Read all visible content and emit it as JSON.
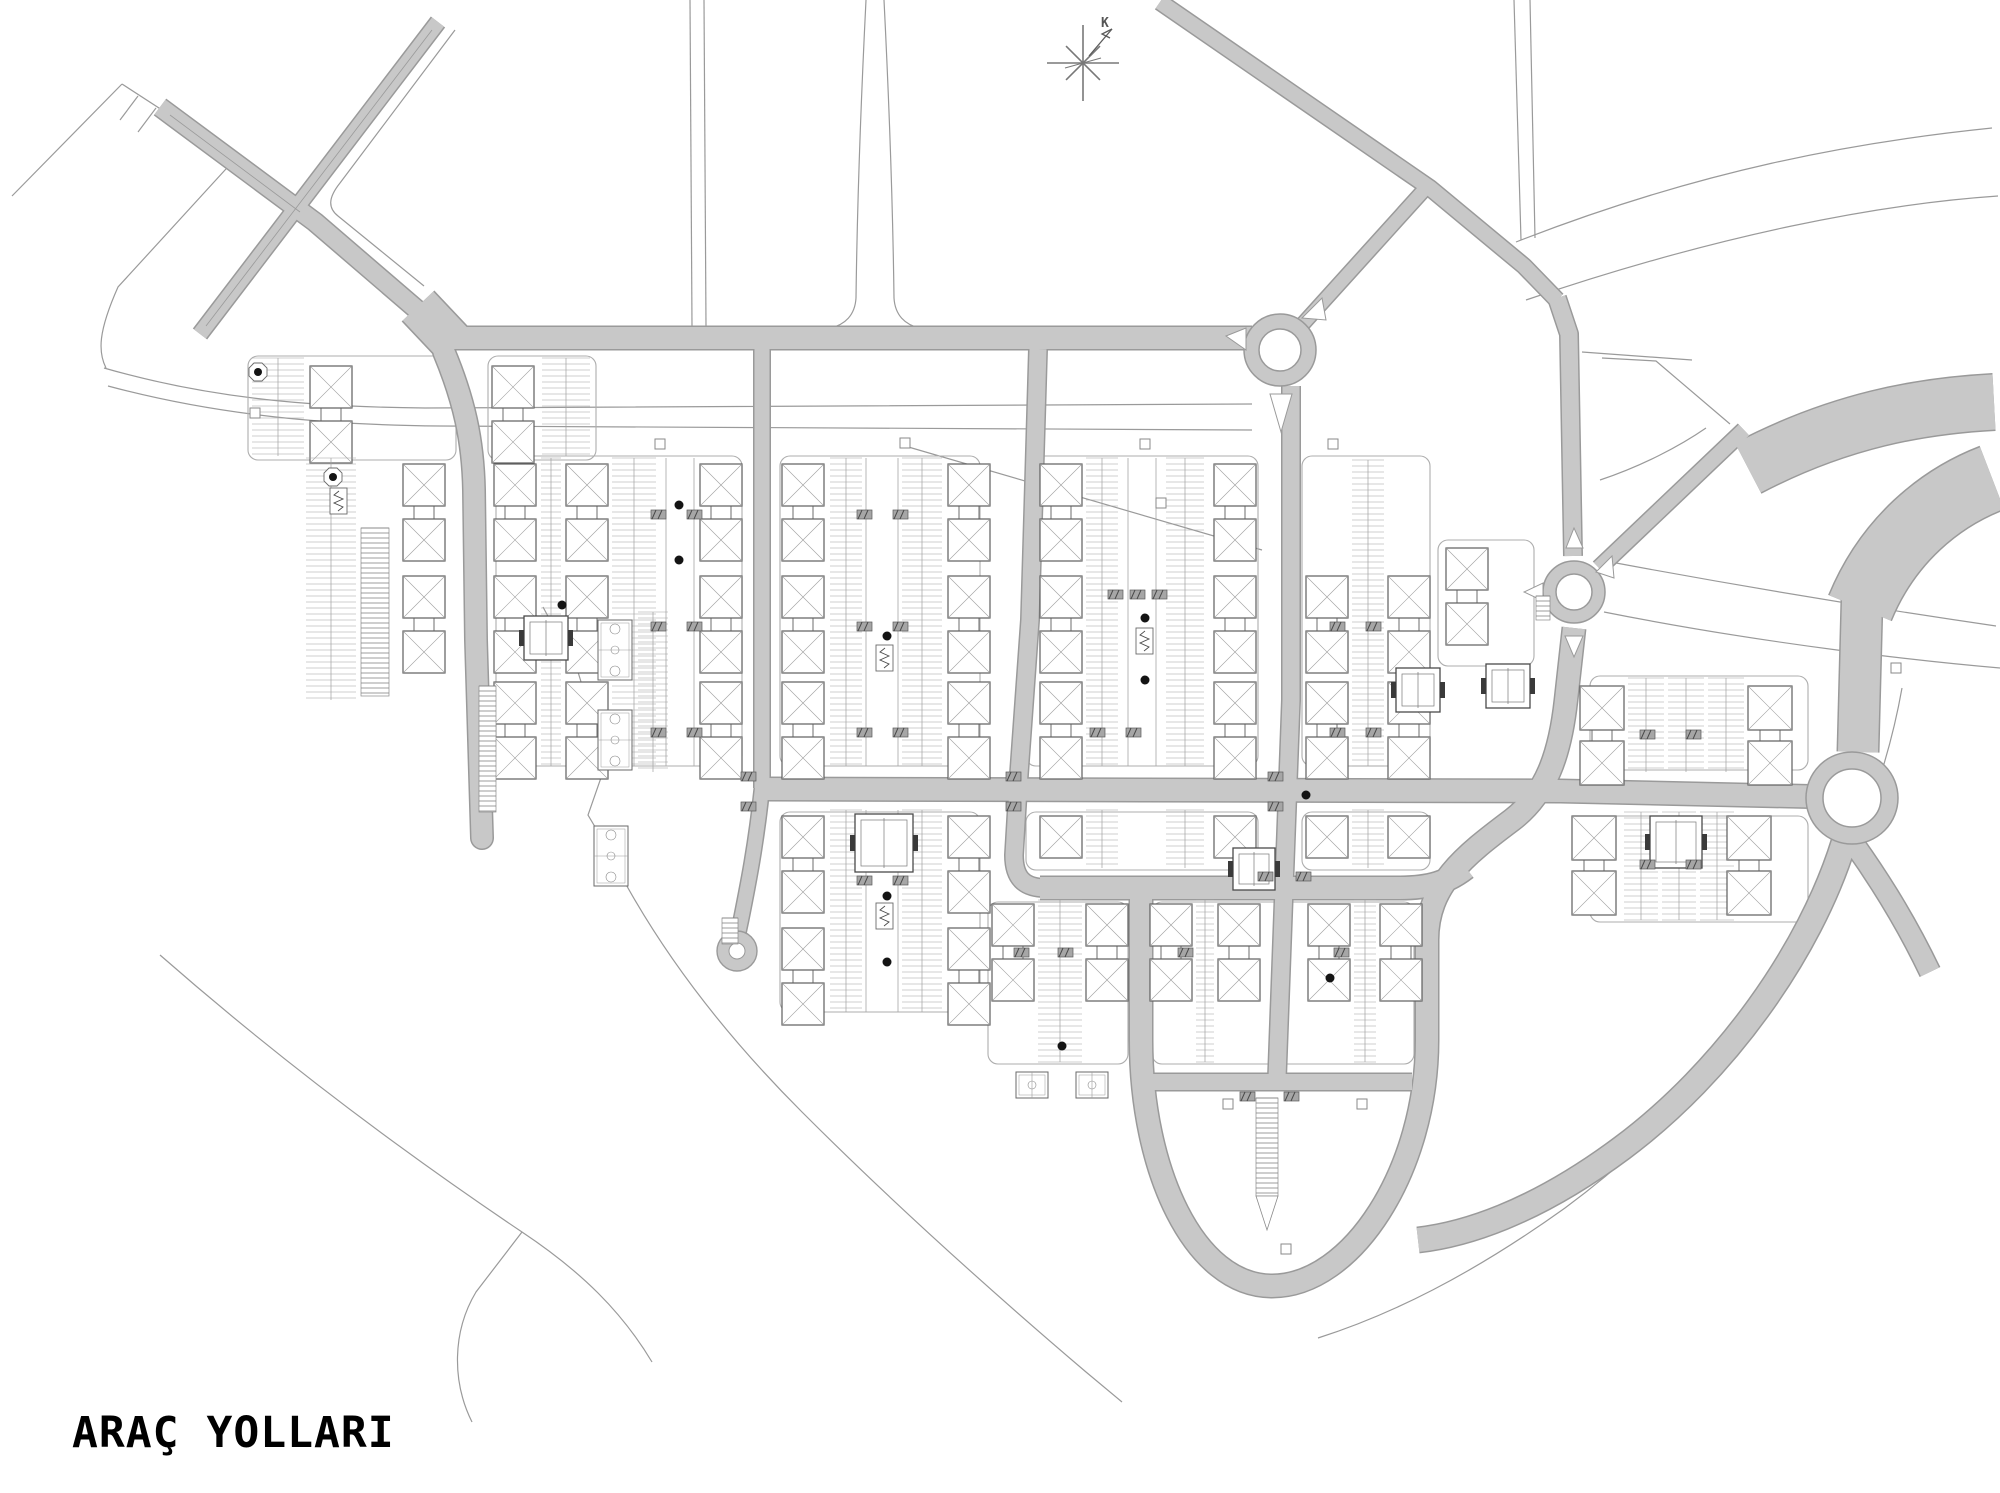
{
  "canvas": {
    "w": 2000,
    "h": 1493
  },
  "title": {
    "text": "ARAÇ YOLLARI"
  },
  "compass": {
    "cx": 1083,
    "cy": 63,
    "label": "K"
  },
  "colors": {
    "bg": "#ffffff",
    "road_fill": "#c8c8c8",
    "road_edge": "#9a9a9a",
    "thin": "#9a9a9a",
    "boundary": "#8d8d8d",
    "plot": "#aeaeae",
    "building": "#5e5e5e",
    "roof": "#a0a0a0",
    "comb": "#9f9f9f",
    "spine": "#a5a5a5",
    "tick_fill": "#a6a6a6",
    "tick_dark": "#4a4a4a",
    "special": "#4a4a4a",
    "tree": "#141414",
    "text": "#000000"
  },
  "roads": [
    {
      "id": "diagonal-sw",
      "d": "M 438,22 L 200,334",
      "w": 15
    },
    {
      "id": "diagonal-nwse",
      "d": "M 160,107 L 315,222 L 443,332",
      "w": 18
    },
    {
      "id": "funnel",
      "d": "M 418,306 L 452,342",
      "w": 42
    },
    {
      "id": "main-horizontal",
      "d": "M 448,338 L 1252,338",
      "w": 22
    },
    {
      "id": "rnd1-ne-link",
      "d": "M 1292,336 L 1424,190",
      "w": 13
    },
    {
      "id": "north-diagonal",
      "d": "M 1160,2 L 1430,188 L 1524,266 L 1557,300",
      "w": 15
    },
    {
      "id": "v5-north-of-rnd2",
      "d": "M 1557,298 L 1569,334 L 1573,556",
      "w": 17
    },
    {
      "id": "ne-approach",
      "d": "M 1744,430 L 1599,568",
      "w": 15
    },
    {
      "id": "v6-and-loop",
      "d": "M 1574,628 L 1566,700 C 1560,755 1546,794 1512,820 C 1464,856 1427,885 1427,940 L 1427,1040 C 1427,1170 1352,1286 1272,1286 C 1194,1286 1141,1170 1141,1040 L 1141,893",
      "w": 22
    },
    {
      "id": "h3-boulevard",
      "d": "M 1040,888 L 1400,888 C 1430,888 1448,882 1466,868",
      "w": 22
    },
    {
      "id": "h4-chord",
      "d": "M 1133,1082 L 1412,1082",
      "w": 16
    },
    {
      "id": "v1",
      "d": "M 444,352 C 464,400 473,440 474,490 L 476,640 L 482,838",
      "w": 21,
      "cap": "round"
    },
    {
      "id": "v2",
      "d": "M 762,349 L 762,788",
      "w": 15
    },
    {
      "id": "v2-south",
      "d": "M 762,788 C 756,845 748,885 741,920 C 738,934 736,942 737,949",
      "w": 14
    },
    {
      "id": "v3",
      "d": "M 1038,349 L 1030,620 L 1018,788 L 1014,855 C 1014,878 1024,888 1046,888",
      "w": 17
    },
    {
      "id": "v4",
      "d": "M 1291,386 L 1291,700 L 1284,888 L 1277,1078",
      "w": 17
    },
    {
      "id": "h2-middle",
      "d": "M 757,789 L 1560,791 L 1832,797",
      "w": 22
    },
    {
      "id": "interchange-a",
      "d": "M 1748,468 C 1840,420 1920,406 1994,402",
      "w": 55
    },
    {
      "id": "interchange-b",
      "d": "M 1992,478 C 1940,498 1888,540 1860,608",
      "w": 66
    },
    {
      "id": "interchange-c",
      "d": "M 1862,600 L 1858,752",
      "w": 40
    },
    {
      "id": "arc-south",
      "d": "M 1844,842 C 1810,952 1724,1072 1622,1148 C 1532,1215 1462,1235 1418,1240",
      "w": 24
    },
    {
      "id": "arc-se-stub",
      "d": "M 1854,844 C 1884,886 1908,926 1930,972",
      "w": 20
    }
  ],
  "overlines": [
    {
      "d": "M 432,30 L 206,326"
    },
    {
      "d": "M 170,115 L 300,212"
    }
  ],
  "roundabouts": [
    {
      "cx": 1280,
      "cy": 350,
      "ro": 36,
      "ri": 21
    },
    {
      "cx": 1574,
      "cy": 592,
      "ro": 31,
      "ri": 18
    },
    {
      "cx": 1852,
      "cy": 798,
      "ro": 46,
      "ri": 29
    }
  ],
  "cul_de_sacs": [
    {
      "cx": 737,
      "cy": 951,
      "ro": 20,
      "ri": 8
    }
  ],
  "islands": [
    "M 1226,336 L 1246,328 L 1246,350 Z",
    "M 1270,394 L 1292,394 L 1281,432 Z",
    "M 1302,318 L 1322,298 L 1326,320 Z",
    "M 1566,548 L 1583,548 L 1574,528 Z",
    "M 1565,636 L 1583,636 L 1574,657 Z",
    "M 1596,572 L 1612,556 L 1614,578 Z",
    "M 1543,583 L 1543,601 L 1524,592 Z"
  ],
  "thin_lines": [
    {
      "d": "M 455,30 L 340,183 C 328,198 328,208 338,216 L 424,286"
    },
    {
      "d": "M 122,84 L 236,158"
    },
    {
      "d": "M 122,84 L 12,196"
    },
    {
      "d": "M 236,158 L 118,287 C 98,332 98,352 106,368"
    },
    {
      "d": "M 138,96 L 120,120"
    },
    {
      "d": "M 156,108 L 138,132"
    },
    {
      "d": "M 104,368 C 215,400 320,407 425,408 L 1252,404"
    },
    {
      "d": "M 108,386 C 220,416 330,425 440,426 L 1252,430"
    },
    {
      "d": "M 690,0 L 692,326"
    },
    {
      "d": "M 704,0 L 706,326"
    },
    {
      "d": "M 866,0 C 860,120 857,220 856,298 C 855,315 845,325 830,328"
    },
    {
      "d": "M 884,0 C 890,120 893,220 894,298 C 895,315 905,325 920,328"
    },
    {
      "d": "M 1514,0 L 1521,240"
    },
    {
      "d": "M 1530,0 L 1535,238"
    },
    {
      "d": "M 1516,242 C 1700,170 1855,142 1992,128"
    },
    {
      "d": "M 1526,300 C 1720,234 1880,204 1998,196"
    },
    {
      "d": "M 1602,358 L 1656,361 L 1730,424"
    },
    {
      "d": "M 1600,480 C 1642,466 1680,446 1706,428"
    },
    {
      "d": "M 1600,560 C 1760,590 1900,612 1996,626"
    },
    {
      "d": "M 1604,612 C 1770,645 1930,662 2000,668"
    },
    {
      "d": "M 1902,688 C 1868,880 1745,1075 1565,1208 C 1470,1276 1390,1315 1318,1338"
    },
    {
      "d": "M 543,607 L 578,672 L 592,718 L 603,772 L 588,815 L 604,842 C 652,942 722,1032 802,1112 C 892,1202 992,1292 1086,1372 L 1122,1402"
    },
    {
      "d": "M 160,955 C 280,1060 400,1150 522,1232 C 582,1272 622,1312 652,1362"
    },
    {
      "d": "M 522,1232 L 476,1292 C 452,1332 452,1382 472,1422"
    },
    {
      "d": "M 1582,352 L 1692,360"
    },
    {
      "d": "M 905,446 L 1262,550"
    }
  ],
  "plots": [
    {
      "x": 496,
      "y": 456,
      "w": 246,
      "h": 310
    },
    {
      "x": 780,
      "y": 456,
      "w": 200,
      "h": 310
    },
    {
      "x": 1026,
      "y": 456,
      "w": 232,
      "h": 310
    },
    {
      "x": 1302,
      "y": 456,
      "w": 128,
      "h": 310
    },
    {
      "x": 780,
      "y": 812,
      "w": 200,
      "h": 200
    },
    {
      "x": 1026,
      "y": 812,
      "w": 232,
      "h": 58
    },
    {
      "x": 1302,
      "y": 812,
      "w": 128,
      "h": 58
    },
    {
      "x": 1152,
      "y": 902,
      "w": 262,
      "h": 162
    },
    {
      "x": 988,
      "y": 902,
      "w": 140,
      "h": 162
    },
    {
      "x": 1590,
      "y": 676,
      "w": 218,
      "h": 94
    },
    {
      "x": 1590,
      "y": 816,
      "w": 218,
      "h": 106
    },
    {
      "x": 1438,
      "y": 540,
      "w": 96,
      "h": 126
    },
    {
      "x": 248,
      "y": 356,
      "w": 208,
      "h": 104
    },
    {
      "x": 488,
      "y": 356,
      "w": 108,
      "h": 104
    }
  ],
  "clusters": [
    {
      "cols": [
        494,
        566,
        700
      ],
      "modules": [
        464,
        576,
        682
      ],
      "singles": [],
      "combs": [
        {
          "x": 541,
          "w": 20
        },
        {
          "x": 612,
          "w": 44
        }
      ],
      "spine": [
        666,
        694
      ],
      "y0": 458,
      "y1": 766
    },
    {
      "cols": [
        782,
        948
      ],
      "modules": [
        464,
        576,
        682
      ],
      "singles": [],
      "combs": [
        {
          "x": 830,
          "w": 32
        },
        {
          "x": 902,
          "w": 40
        }
      ],
      "spine": [
        866,
        898
      ],
      "y0": 458,
      "y1": 766
    },
    {
      "cols": [
        1040,
        1214
      ],
      "modules": [
        464,
        576,
        682
      ],
      "singles": [],
      "combs": [
        {
          "x": 1086,
          "w": 32
        },
        {
          "x": 1166,
          "w": 38
        }
      ],
      "spine": [
        1128,
        1156
      ],
      "y0": 458,
      "y1": 766
    },
    {
      "cols": [
        1306,
        1388
      ],
      "modules": [
        576,
        682
      ],
      "singles": [],
      "combs": [
        {
          "x": 1352,
          "w": 32
        }
      ],
      "spine": null,
      "y0": 460,
      "y1": 766
    },
    {
      "cols": [
        1446
      ],
      "modules": [
        548
      ],
      "singles": [],
      "combs": [],
      "spine": null,
      "y0": 542,
      "y1": 664
    },
    {
      "cols": [
        310
      ],
      "modules": [
        366
      ],
      "singles": [],
      "combs": [
        {
          "x": 252,
          "w": 52
        }
      ],
      "spine": null,
      "y0": 358,
      "y1": 456
    },
    {
      "cols": [
        492
      ],
      "modules": [
        366
      ],
      "singles": [],
      "combs": [
        {
          "x": 542,
          "w": 48
        }
      ],
      "spine": null,
      "y0": 358,
      "y1": 456
    },
    {
      "cols": [
        403
      ],
      "modules": [
        464,
        576
      ],
      "singles": [],
      "combs": [
        {
          "x": 306,
          "w": 50
        }
      ],
      "spine": null,
      "y0": 458,
      "y1": 700
    },
    {
      "cols": [],
      "modules": [],
      "singles": [],
      "combs": [
        {
          "x": 638,
          "w": 30
        }
      ],
      "spine": null,
      "y0": 612,
      "y1": 772
    },
    {
      "cols": [
        782,
        948
      ],
      "modules": [
        816,
        928
      ],
      "singles": [],
      "combs": [
        {
          "x": 830,
          "w": 32
        },
        {
          "x": 902,
          "w": 40
        }
      ],
      "spine": [
        866,
        898
      ],
      "y0": 810,
      "y1": 1012
    },
    {
      "cols": [
        1040,
        1214
      ],
      "modules": [],
      "singles": [
        816
      ],
      "combs": [
        {
          "x": 1086,
          "w": 32
        },
        {
          "x": 1166,
          "w": 38
        }
      ],
      "spine": null,
      "y0": 810,
      "y1": 868
    },
    {
      "cols": [
        1306,
        1388
      ],
      "modules": [],
      "singles": [
        816
      ],
      "combs": [
        {
          "x": 1352,
          "w": 32
        }
      ],
      "spine": null,
      "y0": 810,
      "y1": 868
    },
    {
      "cols": [
        1150,
        1218
      ],
      "modules": [
        904
      ],
      "singles": [],
      "combs": [
        {
          "x": 1196,
          "w": 18
        }
      ],
      "spine": null,
      "y0": 900,
      "y1": 1062
    },
    {
      "cols": [
        1308,
        1380
      ],
      "modules": [
        904
      ],
      "singles": [],
      "combs": [
        {
          "x": 1354,
          "w": 22
        }
      ],
      "spine": null,
      "y0": 900,
      "y1": 1062
    },
    {
      "cols": [
        992,
        1086
      ],
      "modules": [
        904
      ],
      "singles": [],
      "combs": [
        {
          "x": 1038,
          "w": 44
        }
      ],
      "spine": null,
      "y0": 900,
      "y1": 1062
    },
    {
      "cols": [
        1580,
        1748
      ],
      "modules": [
        686
      ],
      "singles": [],
      "combs": [
        {
          "x": 1628,
          "w": 36
        },
        {
          "x": 1668,
          "w": 36
        },
        {
          "x": 1708,
          "w": 36
        }
      ],
      "spine": null,
      "y0": 678,
      "y1": 772,
      "sq": 44
    },
    {
      "cols": [
        1572,
        1727
      ],
      "modules": [
        816
      ],
      "singles": [],
      "combs": [
        {
          "x": 1624,
          "w": 34
        },
        {
          "x": 1662,
          "w": 34
        },
        {
          "x": 1700,
          "w": 34
        }
      ],
      "spine": null,
      "y0": 812,
      "y1": 920,
      "sq": 44
    }
  ],
  "specials": [
    {
      "x": 524,
      "y": 616,
      "s": 44
    },
    {
      "x": 855,
      "y": 814,
      "s": 58
    },
    {
      "x": 1233,
      "y": 848,
      "s": 42
    },
    {
      "x": 1650,
      "y": 816,
      "s": 52
    },
    {
      "x": 1396,
      "y": 668,
      "s": 44
    },
    {
      "x": 1486,
      "y": 664,
      "s": 44
    }
  ],
  "courts": [
    {
      "x": 598,
      "y": 620,
      "w": 34,
      "h": 60,
      "horiz": false
    },
    {
      "x": 598,
      "y": 710,
      "w": 34,
      "h": 60,
      "horiz": false
    },
    {
      "x": 594,
      "y": 826,
      "w": 34,
      "h": 60,
      "horiz": false
    },
    {
      "x": 1016,
      "y": 1072,
      "w": 32,
      "h": 26,
      "horiz": true
    },
    {
      "x": 1076,
      "y": 1072,
      "w": 32,
      "h": 26,
      "horiz": true
    }
  ],
  "trees": [
    [
      562,
      605
    ],
    [
      887,
      636
    ],
    [
      887,
      896
    ],
    [
      887,
      962
    ],
    [
      1145,
      618
    ],
    [
      1145,
      680
    ],
    [
      1306,
      795
    ],
    [
      1330,
      978
    ],
    [
      1062,
      1046
    ],
    [
      679,
      505
    ],
    [
      679,
      560
    ]
  ],
  "pads": [
    [
      258,
      372
    ],
    [
      333,
      477
    ]
  ],
  "icons": [
    [
      330,
      488
    ],
    [
      876,
      645
    ],
    [
      876,
      903
    ],
    [
      1136,
      628
    ]
  ],
  "ladders": [
    {
      "x": 361,
      "y": 528,
      "w": 28,
      "h": 168
    },
    {
      "x": 479,
      "y": 686,
      "w": 17,
      "h": 126
    },
    {
      "x": 1256,
      "y": 1098,
      "w": 22,
      "h": 98,
      "taper": 34
    },
    {
      "x": 1536,
      "y": 596,
      "w": 14,
      "h": 24
    },
    {
      "x": 722,
      "y": 918,
      "w": 16,
      "h": 26
    }
  ],
  "ticks": [
    [
      651,
      510
    ],
    [
      687,
      510
    ],
    [
      651,
      622
    ],
    [
      687,
      622
    ],
    [
      651,
      728
    ],
    [
      687,
      728
    ],
    [
      857,
      510
    ],
    [
      893,
      510
    ],
    [
      857,
      622
    ],
    [
      893,
      622
    ],
    [
      857,
      728
    ],
    [
      893,
      728
    ],
    [
      857,
      876
    ],
    [
      893,
      876
    ],
    [
      1108,
      590
    ],
    [
      1130,
      590
    ],
    [
      1152,
      590
    ],
    [
      1090,
      728
    ],
    [
      1126,
      728
    ],
    [
      1330,
      622
    ],
    [
      1366,
      622
    ],
    [
      1330,
      728
    ],
    [
      1366,
      728
    ],
    [
      741,
      772
    ],
    [
      741,
      802
    ],
    [
      1006,
      772
    ],
    [
      1006,
      802
    ],
    [
      1268,
      772
    ],
    [
      1268,
      802
    ],
    [
      1258,
      872
    ],
    [
      1296,
      872
    ],
    [
      1240,
      1092
    ],
    [
      1284,
      1092
    ],
    [
      1178,
      948
    ],
    [
      1334,
      948
    ],
    [
      1014,
      948
    ],
    [
      1058,
      948
    ],
    [
      1640,
      730
    ],
    [
      1686,
      730
    ],
    [
      1640,
      860
    ],
    [
      1686,
      860
    ]
  ],
  "markers": [
    [
      255,
      413
    ],
    [
      660,
      444
    ],
    [
      905,
      443
    ],
    [
      1145,
      444
    ],
    [
      1333,
      444
    ],
    [
      1161,
      503
    ],
    [
      1228,
      1104
    ],
    [
      1362,
      1104
    ],
    [
      1286,
      1249
    ],
    [
      1896,
      668
    ]
  ]
}
